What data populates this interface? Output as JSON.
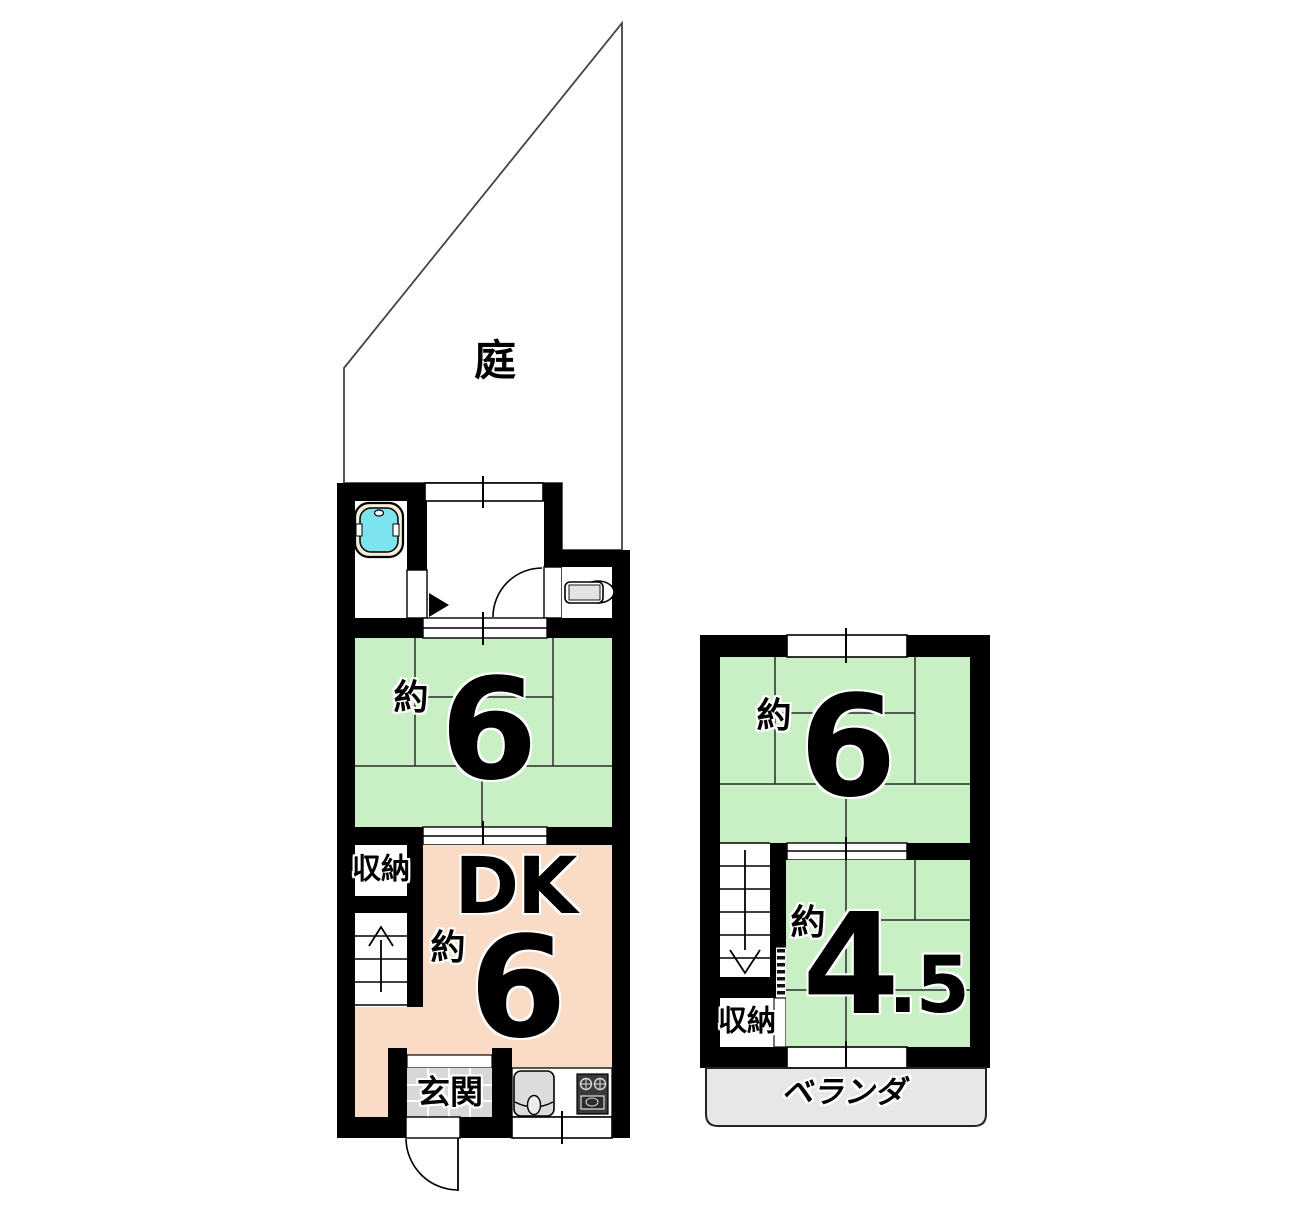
{
  "document": {
    "type": "floor-plan",
    "background": "#ffffff"
  },
  "colors": {
    "wall": "#000000",
    "tatami_green": "#c9f0c4",
    "dk_pink": "#fadbc6",
    "veranda_gray": "#e7e7e7",
    "entrance_tile_gray": "#d8d8d8",
    "bathtub_cyan": "#7de3ee",
    "bathtub_rim_cream": "#f5eed6",
    "fixture_gray": "#dcdcdc",
    "stove_dark": "#3a3a3a",
    "thin_line": "#222222"
  },
  "garden": {
    "label": "庭"
  },
  "floor1": {
    "tatami_room": {
      "prefix": "約",
      "size": "6"
    },
    "dk": {
      "title": "DK",
      "prefix": "約",
      "size": "6"
    },
    "storage": {
      "label": "収納"
    },
    "entrance": {
      "label": "玄関"
    }
  },
  "floor2": {
    "tatami_room": {
      "prefix": "約",
      "size": "6"
    },
    "tatami_room_small": {
      "prefix": "約",
      "size_main": "4",
      "size_decimal": ".5"
    },
    "storage": {
      "label": "収納"
    },
    "veranda": {
      "label": "ベランダ"
    }
  },
  "icons": {
    "fixtures": [
      "bathtub-icon",
      "toilet-icon",
      "kitchen-sink-icon",
      "stove-icon"
    ],
    "symbols": [
      "stairs-up-arrow-icon",
      "stairs-down-arrow-icon",
      "door-swing-icon",
      "window-tick-icon",
      "bath-door-triangle-icon"
    ]
  }
}
